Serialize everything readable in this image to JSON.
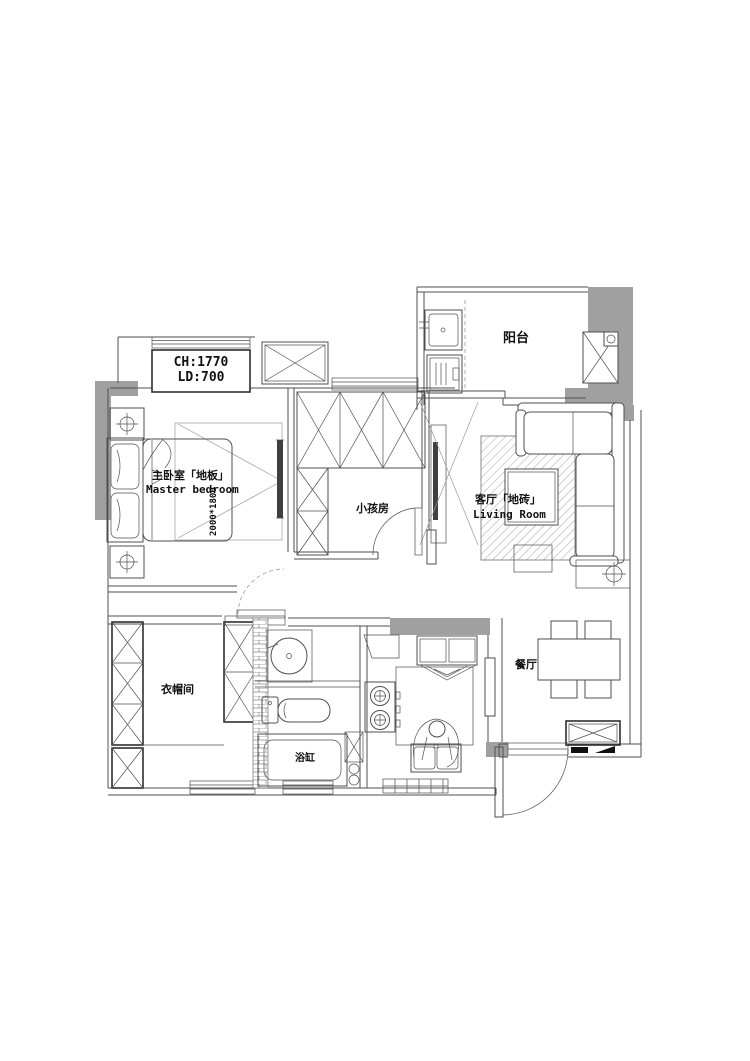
{
  "drawing": {
    "type": "apartment-floor-plan",
    "colors": {
      "background": "#ffffff",
      "line": "#4f4f4f",
      "wall_gray": "#a0a0a0",
      "black": "#111111"
    }
  },
  "annotations": {
    "ceiling_line1": "CH:1770",
    "ceiling_line2": "LD:700"
  },
  "rooms": {
    "master_bedroom": {
      "label_zh": "主卧室「地板」",
      "label_en": "Master bedroom",
      "bed_size": "2000*1800"
    },
    "kids_room": {
      "label_zh": "小孩房"
    },
    "living_room": {
      "label_zh": "客厅「地砖」",
      "label_en": "Living Room"
    },
    "balcony": {
      "label_zh": "阳台"
    },
    "cloakroom": {
      "label_zh": "衣帽间"
    },
    "dining_room": {
      "label_zh": "餐厅"
    },
    "bathroom": {
      "bathtub_label": "浴缸"
    }
  }
}
